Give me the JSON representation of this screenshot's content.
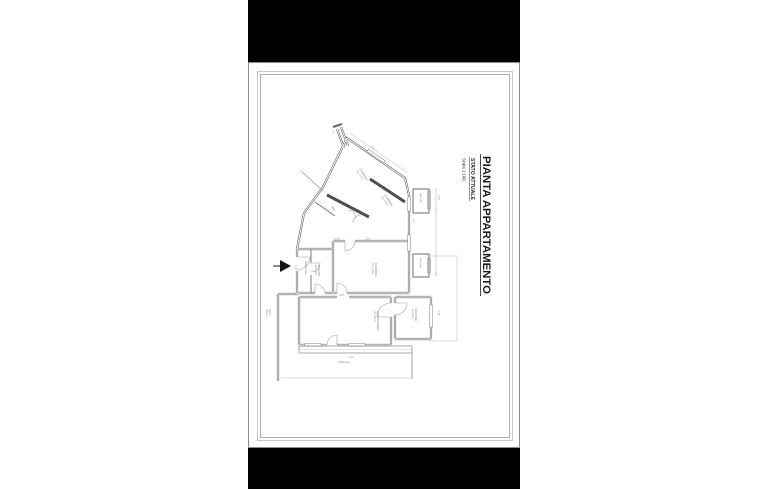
{
  "viewer": {
    "background": "#000000"
  },
  "page": {
    "background": "#ffffff",
    "frame_color": "#bdbdbd",
    "edge_color": "#8c8c8c"
  },
  "title_block": {
    "main": "PIANTA APPARTAMENTO",
    "status": "STATO ATTUALE",
    "scale": "Scala 1:100"
  },
  "plan": {
    "wall_color": "#6a6a6a",
    "thick_wall_color": "#4f4f4f",
    "thin_line_color": "#9a9a9a",
    "rooms": [
      {
        "name": "CAMERA",
        "area": "mq 14,20"
      },
      {
        "name": "CAMERA",
        "area": "mq 12,60"
      },
      {
        "name": "RIP."
      },
      {
        "name": "BAGNO",
        "area": "mq 4,80"
      },
      {
        "name": "INGRESSO"
      },
      {
        "name": "CAMERA",
        "area": "mq 11,40"
      },
      {
        "name": "SOGGIORNO",
        "area": "mq 18,70"
      },
      {
        "name": "CUCINA",
        "area": "mq 8,90"
      },
      {
        "name": "BALCONE"
      },
      {
        "name": "BALCONE"
      },
      {
        "name": "Balcone"
      }
    ],
    "labels": {
      "stairwell_line1": "VANO",
      "stairwell_line2": "SCALA"
    },
    "dims": [
      "3,95",
      "1,10",
      "4,10",
      "1,30",
      "2,45",
      "3,50",
      "1,20",
      "4,95",
      "2,80",
      "3,60"
    ]
  }
}
